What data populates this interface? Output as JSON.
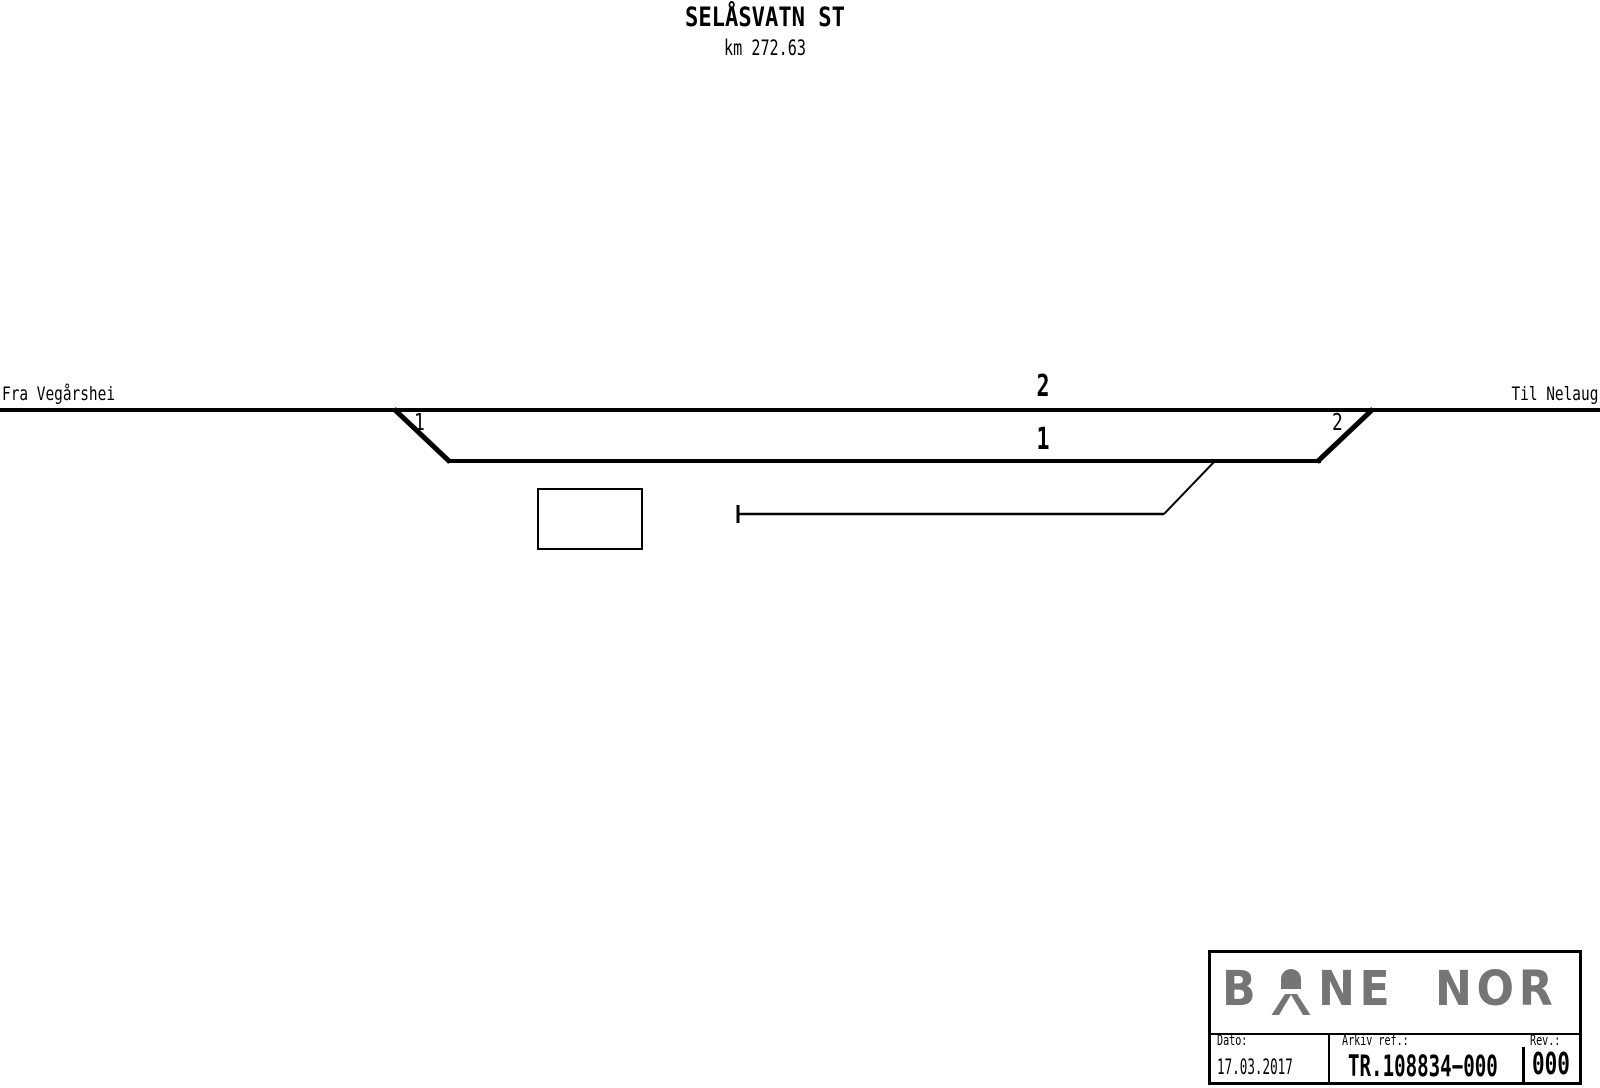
{
  "station": {
    "name": "SELÅSVATN ST",
    "km": "km 272.63"
  },
  "diagram": {
    "from_label": "Fra Vegårshei",
    "to_label": "Til Nelaug",
    "main_track_number": "2",
    "loop_track_number": "1",
    "switch_left_label": "1",
    "switch_right_label": "2"
  },
  "title_block": {
    "logo": {
      "part1": "B",
      "part2": "NE",
      "part3": "NOR",
      "symbol": "bane-nor-a-symbol"
    },
    "dato_label": "Dato:",
    "dato_value": "17.03.2017",
    "arkiv_label": "Arkiv ref.:",
    "arkiv_value": "TR.108834−000",
    "rev_label": "Rev.:",
    "rev_value": "000"
  },
  "colors": {
    "line": "#000000",
    "logo_gray": "#757575",
    "background": "#ffffff"
  }
}
